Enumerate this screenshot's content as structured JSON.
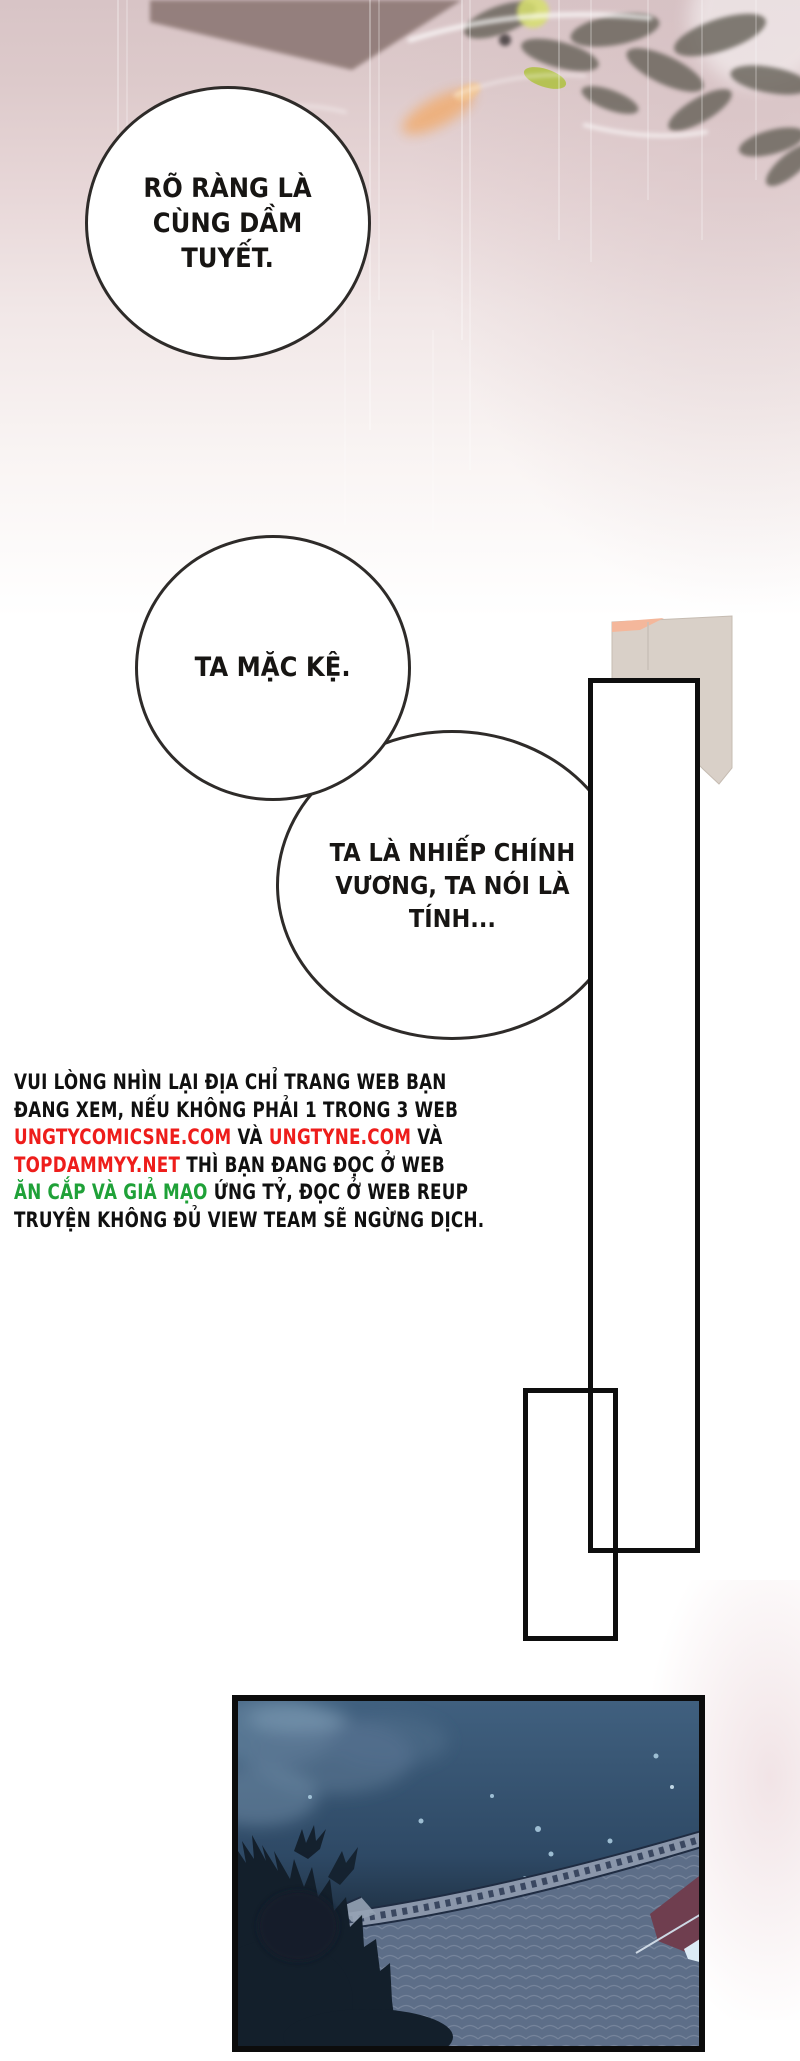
{
  "bubbles": [
    {
      "lines": [
        "RÕ RÀNG LÀ",
        "CÙNG DẦM",
        "TUYẾT."
      ]
    },
    {
      "lines": [
        "TA MẶC KỆ."
      ]
    },
    {
      "lines": [
        "TA LÀ NHIẾP CHÍNH",
        "VƯƠNG, TA NÓI LÀ",
        "TÍNH..."
      ]
    }
  ],
  "notice": {
    "lines": [
      {
        "segments": [
          {
            "text": "VUI LÒNG NHÌN LẠI ĐỊA CHỈ TRANG WEB BẠN",
            "color": "black"
          }
        ]
      },
      {
        "segments": [
          {
            "text": "ĐANG XEM, NẾU KHÔNG PHẢI 1 TRONG 3 WEB",
            "color": "black"
          }
        ]
      },
      {
        "segments": [
          {
            "text": "UNGTYCOMICSNE.COM",
            "color": "red"
          },
          {
            "text": " VÀ ",
            "color": "black"
          },
          {
            "text": "UNGTYNE.COM",
            "color": "red"
          },
          {
            "text": " VÀ",
            "color": "black"
          }
        ]
      },
      {
        "segments": [
          {
            "text": "TOPDAMMYY.NET",
            "color": "red"
          },
          {
            "text": " THÌ BẠN ĐANG ĐỌC Ở WEB",
            "color": "black"
          }
        ]
      },
      {
        "segments": [
          {
            "text": "ĂN CẮP VÀ GIẢ MẠO",
            "color": "green"
          },
          {
            "text": " ỨNG TỶ, ĐỌC Ở WEB REUP",
            "color": "black"
          }
        ]
      },
      {
        "segments": [
          {
            "text": "TRUYỆN KHÔNG ĐỦ VIEW TEAM SẼ NGỪNG DỊCH.",
            "color": "black"
          }
        ]
      }
    ]
  },
  "colors": {
    "notice_red": "#ee1d1b",
    "notice_green": "#1fa138",
    "notice_black": "#101010",
    "page_top_pink": "#d8c4c6",
    "flag_beige": "#d9d0c8",
    "flag_salmon": "#f4b79b",
    "night_sky": "#2e4763",
    "roof_tile": "#5d6e88",
    "roof_maroon": "#6f3e4f",
    "tree_silhouette": "#131f2b",
    "frame_border": "#0e0e0e"
  }
}
